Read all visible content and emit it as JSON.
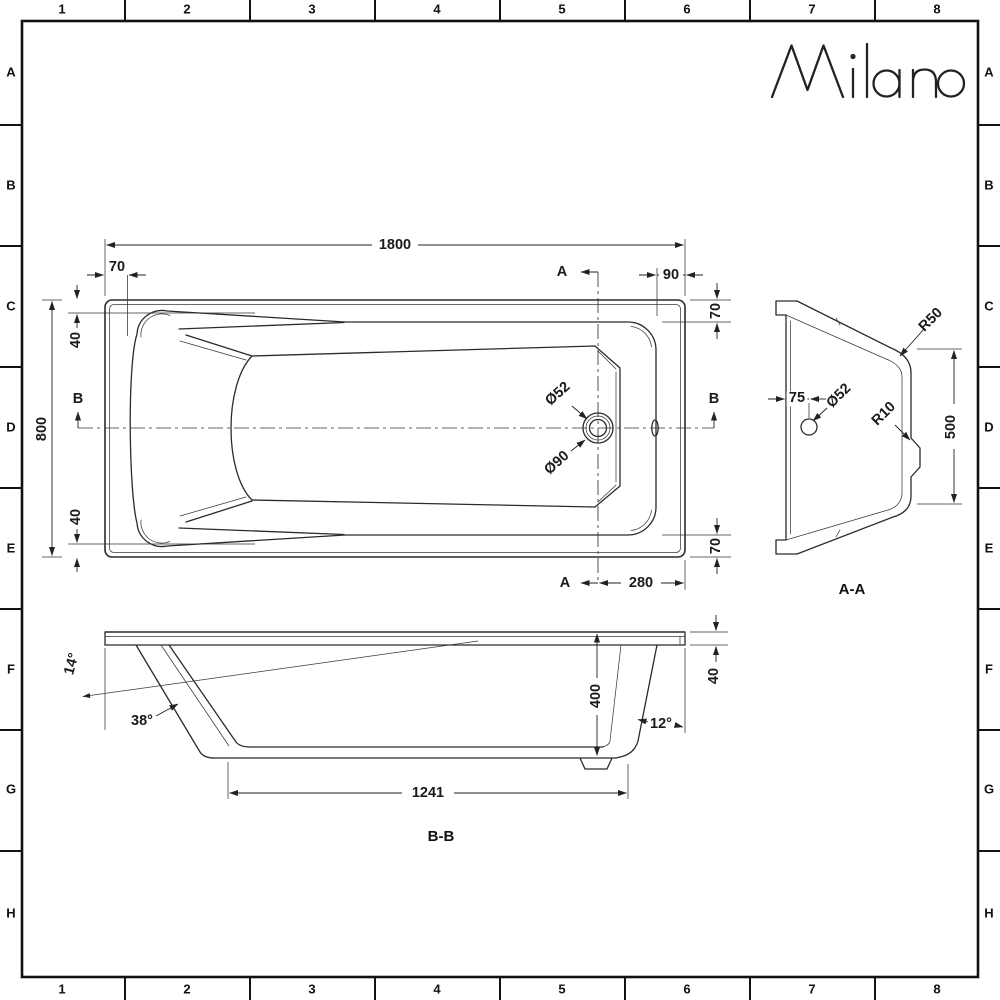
{
  "sheet": {
    "brand": "Milano",
    "grid": {
      "columns": [
        "1",
        "2",
        "3",
        "4",
        "5",
        "6",
        "7",
        "8"
      ],
      "rows": [
        "A",
        "B",
        "C",
        "D",
        "E",
        "F",
        "G",
        "H"
      ]
    }
  },
  "plan": {
    "dims": {
      "overall_length": "1800",
      "overall_width": "800",
      "rim_head": "70",
      "rim_foot": "90",
      "rim_side_top": "70",
      "rim_side_bottom": "70",
      "head_inset_top": "40",
      "head_inset_bottom": "40",
      "waste_offset": "280",
      "waste_dia": "Ø52",
      "waste_flange_dia": "Ø90"
    },
    "markers": {
      "a_top": "A",
      "a_bottom": "A",
      "b_left": "B",
      "b_right": "B"
    }
  },
  "section_aa": {
    "label": "A-A",
    "dims": {
      "overflow_offset": "75",
      "overflow_dia": "Ø52",
      "rim_radius": "R50",
      "recess_radius": "R10",
      "base_width": "500"
    }
  },
  "section_bb": {
    "label": "B-B",
    "dims": {
      "head_angle": "14°",
      "backrest_angle": "38°",
      "foot_angle": "12°",
      "depth": "400",
      "rim_height": "40",
      "base_length": "1241"
    }
  }
}
